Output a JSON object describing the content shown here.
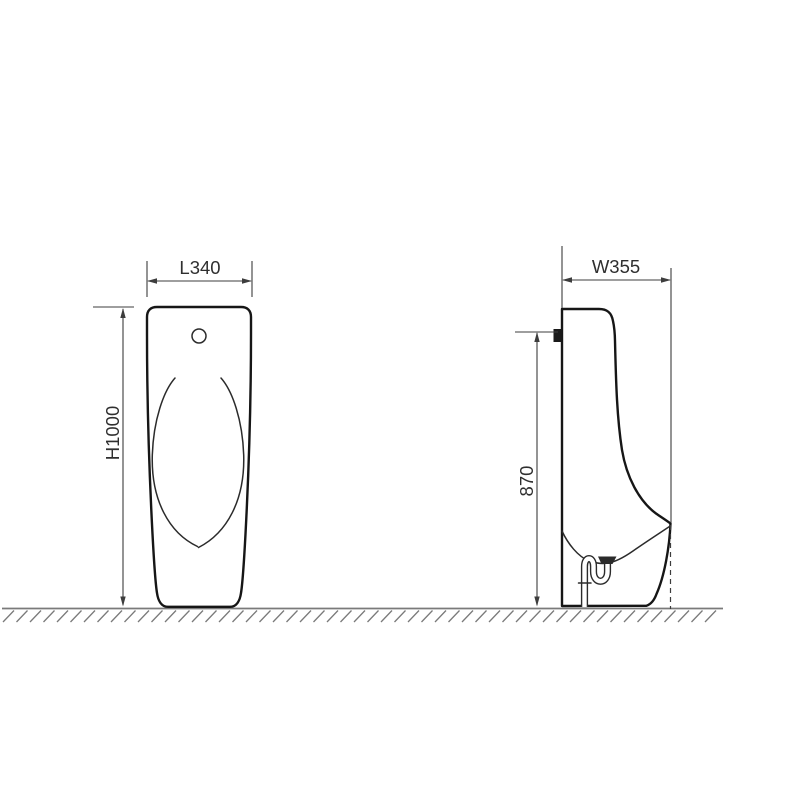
{
  "canvas": {
    "background": "#ffffff"
  },
  "colors": {
    "outline": "#161616",
    "detail": "#2b2b2b",
    "dimension": "#3d3d3d",
    "ground": "#7a7a7a",
    "text": "#2f2f2f"
  },
  "dimensions": {
    "front_width": "L340",
    "front_height": "H1000",
    "side_depth": "W355",
    "side_inlet_height": "870"
  }
}
